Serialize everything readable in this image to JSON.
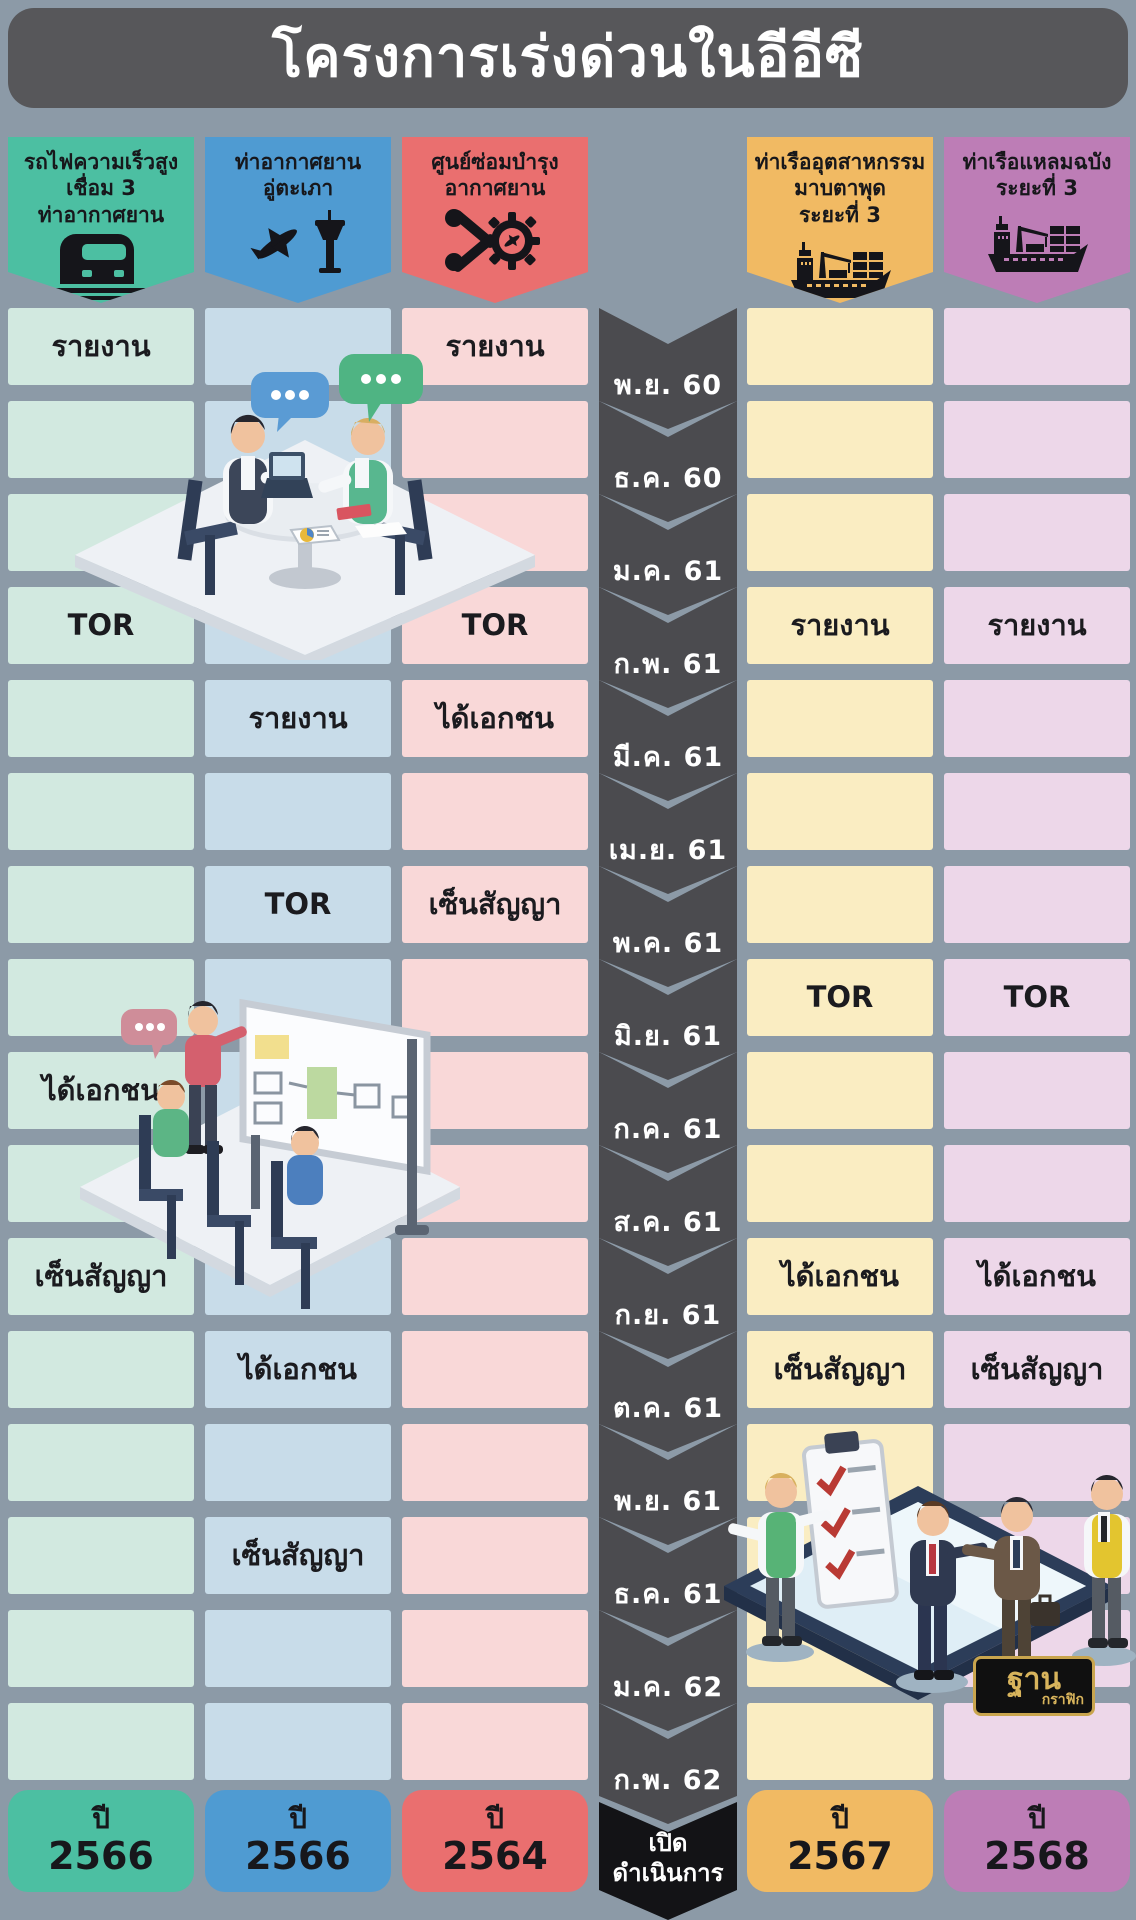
{
  "title": "โครงการเร่งด่วนในอีอีซี",
  "colors": {
    "background": "#8C9AA7",
    "title_bar": "#57575A",
    "timeline_chevron": "#4B4B4F",
    "final_chevron": "#131316",
    "month_text": "#FFFFFF",
    "label_text": "#1B1B1F"
  },
  "timeline": {
    "months": [
      "พ.ย. 60",
      "ธ.ค. 60",
      "ม.ค. 61",
      "ก.พ. 61",
      "มี.ค. 61",
      "เม.ย. 61",
      "พ.ค. 61",
      "มิ.ย. 61",
      "ก.ค. 61",
      "ส.ค. 61",
      "ก.ย. 61",
      "ต.ค. 61",
      "พ.ย. 61",
      "ธ.ค. 61",
      "ม.ค. 62",
      "ก.พ. 62"
    ],
    "final_label": "เปิด\nดำเนินการ"
  },
  "projects": [
    {
      "id": "high-speed-rail",
      "name": "รถไฟความเร็วสูง\nเชื่อม 3\nท่าอากาศยาน",
      "icon": "train-icon",
      "colors": {
        "header": "#4CBFA2",
        "cell": "#D2E9E0"
      },
      "milestones": [
        {
          "row": 1,
          "label": "รายงาน"
        },
        {
          "row": 4,
          "label": "TOR"
        },
        {
          "row": 9,
          "label": "ได้เอกชน"
        },
        {
          "row": 11,
          "label": "เซ็นสัญญา"
        }
      ],
      "year_prefix": "ปี",
      "year": "2566"
    },
    {
      "id": "u-tapao-airport",
      "name": "ท่าอากาศยาน\nอู่ตะเภา",
      "icon": "airplane-tower-icon",
      "colors": {
        "header": "#4F9BD2",
        "cell": "#C8DCE9"
      },
      "milestones": [
        {
          "row": 5,
          "label": "รายงาน"
        },
        {
          "row": 7,
          "label": "TOR"
        },
        {
          "row": 12,
          "label": "ได้เอกชน"
        },
        {
          "row": 14,
          "label": "เซ็นสัญญา"
        }
      ],
      "year_prefix": "ปี",
      "year": "2566"
    },
    {
      "id": "aircraft-maintenance-center",
      "name": "ศูนย์ซ่อมบำรุง\nอากาศยาน",
      "icon": "maintenance-icon",
      "colors": {
        "header": "#EA6F6F",
        "cell": "#F9D8D8"
      },
      "milestones": [
        {
          "row": 1,
          "label": "รายงาน"
        },
        {
          "row": 4,
          "label": "TOR"
        },
        {
          "row": 5,
          "label": "ได้เอกชน"
        },
        {
          "row": 7,
          "label": "เซ็นสัญญา"
        }
      ],
      "year_prefix": "ปี",
      "year": "2564"
    },
    {
      "id": "map-ta-phut-port",
      "name": "ท่าเรืออุตสาหกรรม\nมาบตาพุด\nระยะที่ 3",
      "icon": "cargo-ship-icon",
      "colors": {
        "header": "#F1BA63",
        "cell": "#FAEDC2"
      },
      "milestones": [
        {
          "row": 4,
          "label": "รายงาน"
        },
        {
          "row": 8,
          "label": "TOR"
        },
        {
          "row": 11,
          "label": "ได้เอกชน"
        },
        {
          "row": 12,
          "label": "เซ็นสัญญา"
        }
      ],
      "year_prefix": "ปี",
      "year": "2567"
    },
    {
      "id": "laem-chabang-port",
      "name": "ท่าเรือแหลมฉบัง\nระยะที่ 3",
      "icon": "cargo-ship-icon",
      "colors": {
        "header": "#BD7DB6",
        "cell": "#EDD7E9"
      },
      "milestones": [
        {
          "row": 4,
          "label": "รายงาน"
        },
        {
          "row": 8,
          "label": "TOR"
        },
        {
          "row": 11,
          "label": "ได้เอกชน"
        },
        {
          "row": 12,
          "label": "เซ็นสัญญา"
        }
      ],
      "year_prefix": "ปี",
      "year": "2568"
    }
  ],
  "logo": {
    "top": "ฐาน",
    "bottom": "กราฟิก"
  },
  "chart_data": {
    "type": "table",
    "title": "โครงการเร่งด่วนในอีอีซี",
    "x": [
      "พ.ย. 60",
      "ธ.ค. 60",
      "ม.ค. 61",
      "ก.พ. 61",
      "มี.ค. 61",
      "เม.ย. 61",
      "พ.ค. 61",
      "มิ.ย. 61",
      "ก.ค. 61",
      "ส.ค. 61",
      "ก.ย. 61",
      "ต.ค. 61",
      "พ.ย. 61",
      "ธ.ค. 61",
      "ม.ค. 62",
      "ก.พ. 62"
    ],
    "legend_position": "top",
    "series": [
      {
        "name": "รถไฟความเร็วสูงเชื่อม 3 ท่าอากาศยาน",
        "color": "#4CBFA2",
        "milestones": {
          "พ.ย. 60": "รายงาน",
          "ก.พ. 61": "TOR",
          "ก.ค. 61": "ได้เอกชน",
          "ก.ย. 61": "เซ็นสัญญา"
        },
        "operation_start": "ปี 2566"
      },
      {
        "name": "ท่าอากาศยานอู่ตะเภา",
        "color": "#4F9BD2",
        "milestones": {
          "มี.ค. 61": "รายงาน",
          "พ.ค. 61": "TOR",
          "ต.ค. 61": "ได้เอกชน",
          "ธ.ค. 61": "เซ็นสัญญา"
        },
        "operation_start": "ปี 2566"
      },
      {
        "name": "ศูนย์ซ่อมบำรุงอากาศยาน",
        "color": "#EA6F6F",
        "milestones": {
          "พ.ย. 60": "รายงาน",
          "ก.พ. 61": "TOR",
          "มี.ค. 61": "ได้เอกชน",
          "พ.ค. 61": "เซ็นสัญญา"
        },
        "operation_start": "ปี 2564"
      },
      {
        "name": "ท่าเรืออุตสาหกรรมมาบตาพุด ระยะที่ 3",
        "color": "#F1BA63",
        "milestones": {
          "ก.พ. 61": "รายงาน",
          "มิ.ย. 61": "TOR",
          "ก.ย. 61": "ได้เอกชน",
          "ต.ค. 61": "เซ็นสัญญา"
        },
        "operation_start": "ปี 2567"
      },
      {
        "name": "ท่าเรือแหลมฉบัง ระยะที่ 3",
        "color": "#BD7DB6",
        "milestones": {
          "ก.พ. 61": "รายงาน",
          "มิ.ย. 61": "TOR",
          "ก.ย. 61": "ได้เอกชน",
          "ต.ค. 61": "เซ็นสัญญา"
        },
        "operation_start": "ปี 2568"
      }
    ],
    "footer": "เปิดดำเนินการ"
  }
}
